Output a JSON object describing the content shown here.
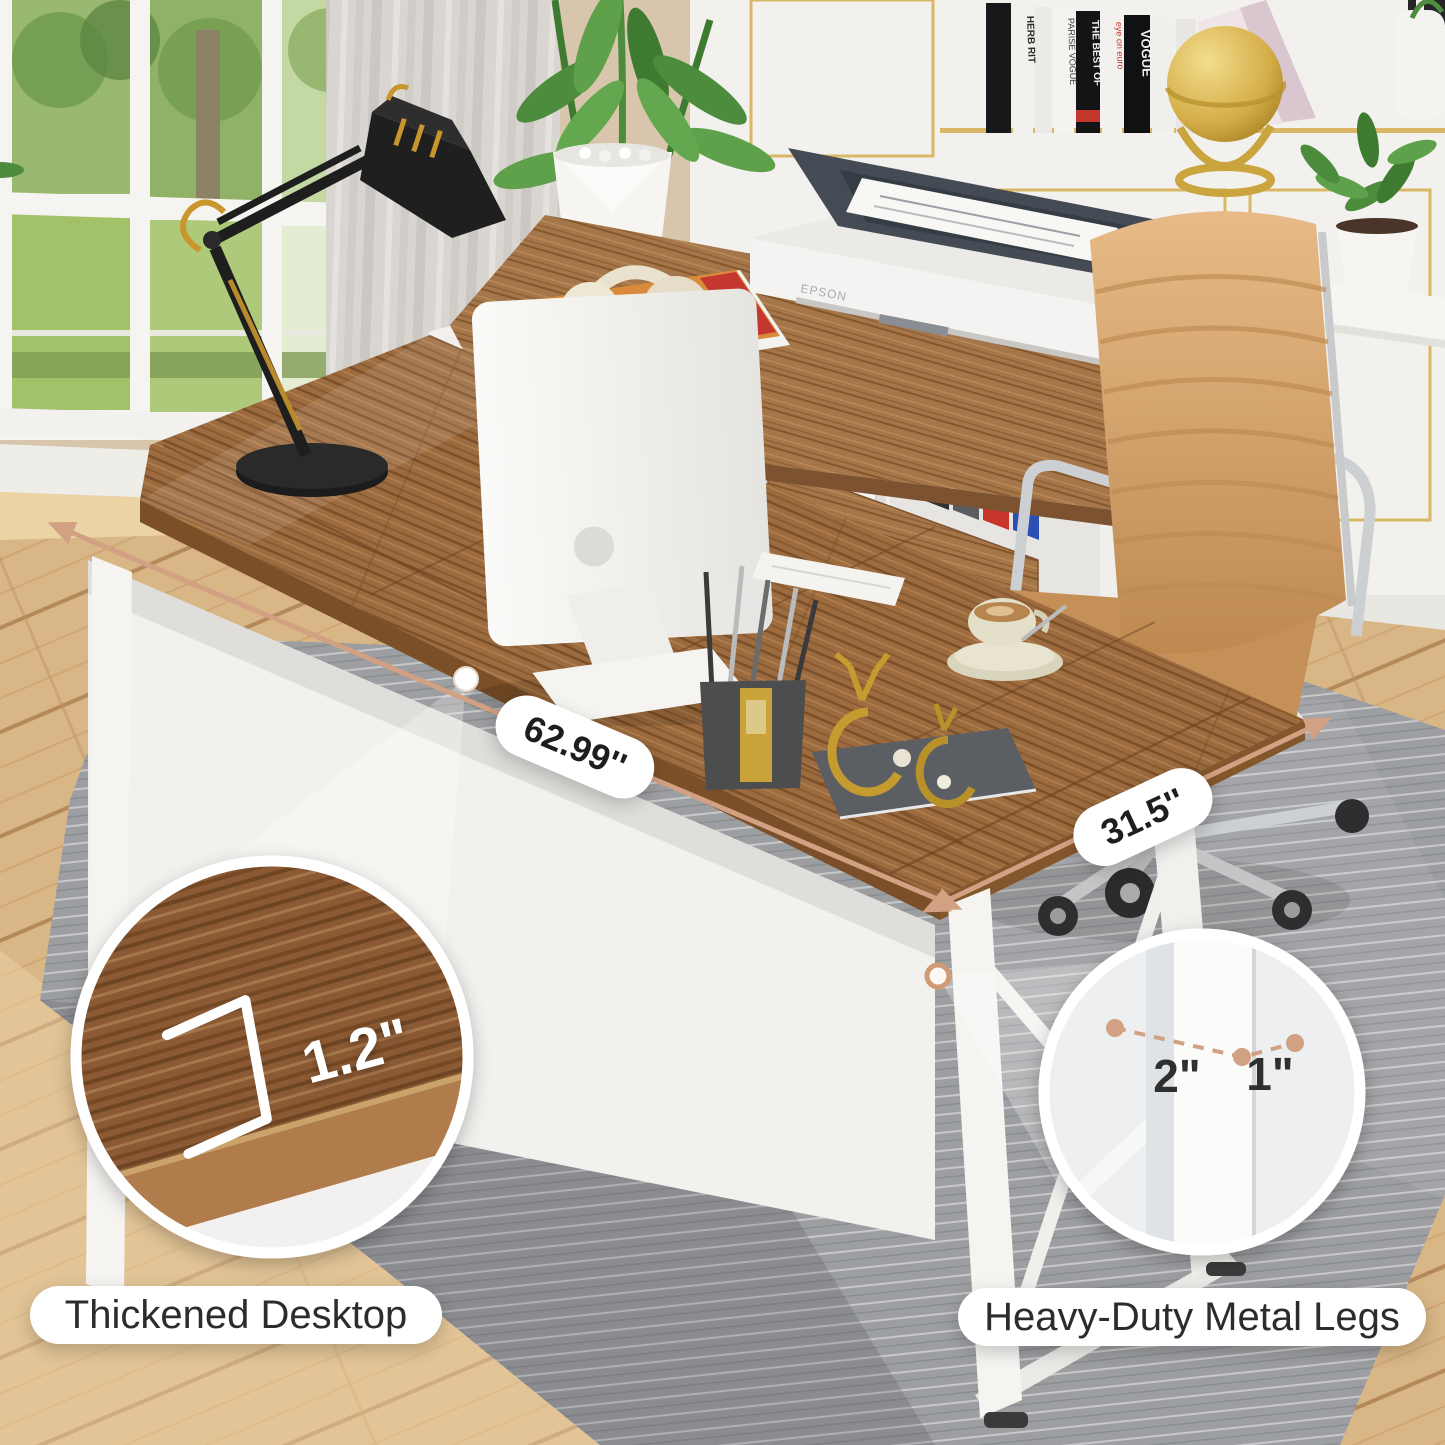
{
  "meta": {
    "title": "L-shaped desk product feature image",
    "type": "product-photo"
  },
  "dimensions": {
    "desk_length": "62.99''",
    "desk_depth": "31.5''",
    "desktop_thickness": "1.2\"",
    "leg_side_a": "2\"",
    "leg_side_b": "1\""
  },
  "features": {
    "left_label": "Thickened Desktop",
    "right_label": "Heavy-Duty Metal Legs"
  },
  "scene": {
    "printer_brand": "EPSON",
    "books": [
      "HERB RIT",
      "PARISE VOGUE",
      "THE BEST OF",
      "eye on euro",
      "VOGUE"
    ]
  },
  "colors": {
    "accent_tan": "#d2a082",
    "desk_wood": "#9c6b3f",
    "metal_white": "#f4f3f0",
    "rug_gray": "#9c9ea1",
    "floor_oak": "#d9b686",
    "chair_tan": "#d2a06c",
    "gold_trim": "#c9a649",
    "label_text": "#2c2c2c"
  }
}
